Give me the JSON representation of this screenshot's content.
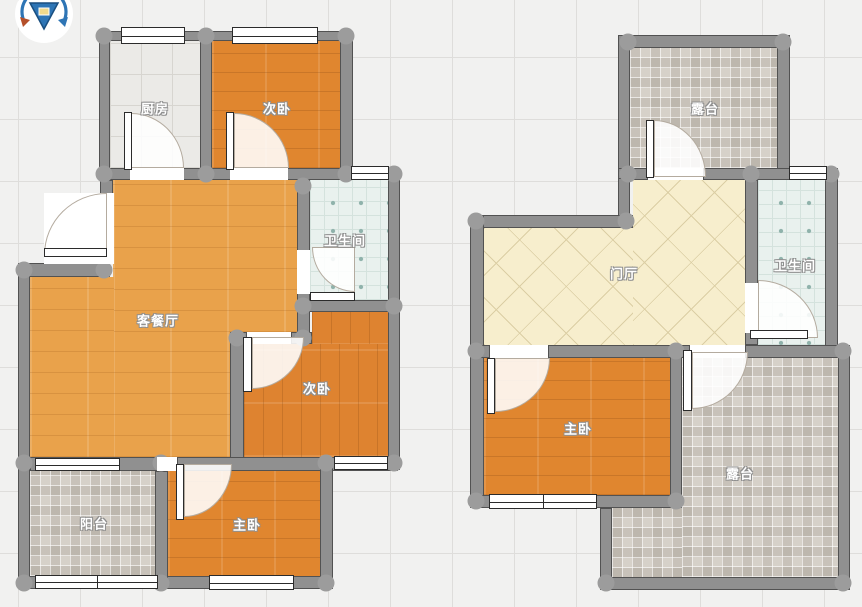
{
  "compass": {
    "icon": "rotate-compass-icon"
  },
  "plans": [
    {
      "rooms": [
        {
          "label": "厨房"
        },
        {
          "label": "次卧"
        },
        {
          "label": "卫生间"
        },
        {
          "label": "客餐厅"
        },
        {
          "label": "次卧"
        },
        {
          "label": "阳台"
        },
        {
          "label": "主卧"
        }
      ]
    },
    {
      "rooms": [
        {
          "label": "露台"
        },
        {
          "label": "门厅"
        },
        {
          "label": "卫生间"
        },
        {
          "label": "主卧"
        },
        {
          "label": "露台"
        }
      ]
    }
  ],
  "palette": {
    "wall": "#909090",
    "wood_bedroom": "#e0862f",
    "wood_living": "#e9a24b",
    "tile_kitchen": "#ebeae7",
    "tile_bath": "#e9f1ee",
    "tile_hall": "#f7eecd",
    "mosaic": "#d6d1c9",
    "compass_blue": "#2e75b5",
    "background": "#f1f1f0"
  }
}
